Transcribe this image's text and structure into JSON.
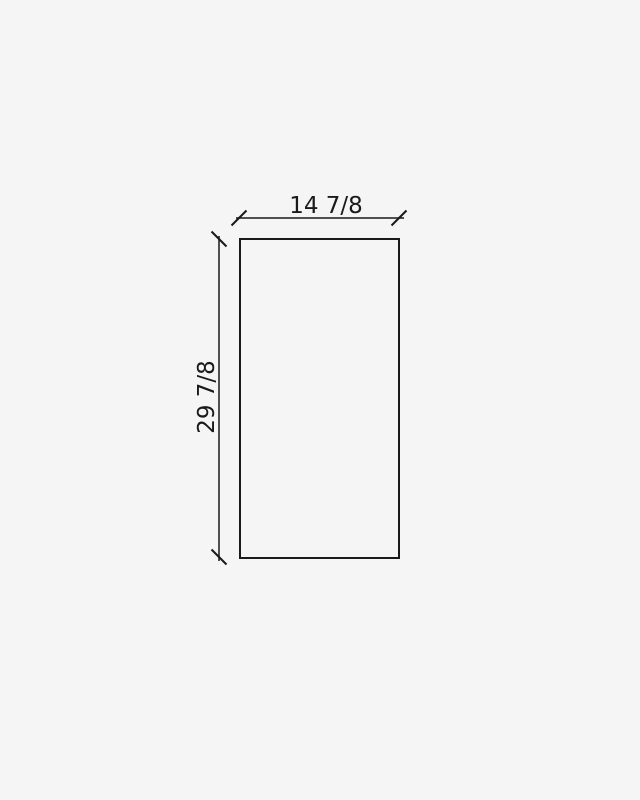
{
  "diagram": {
    "type": "dimension-drawing",
    "shape": "rectangle",
    "width_label": "14 7/8",
    "height_label": "29 7/8",
    "colors": {
      "background": "#f5f5f5",
      "line": "#1a1a1a",
      "text": "#1a1a1a"
    }
  }
}
